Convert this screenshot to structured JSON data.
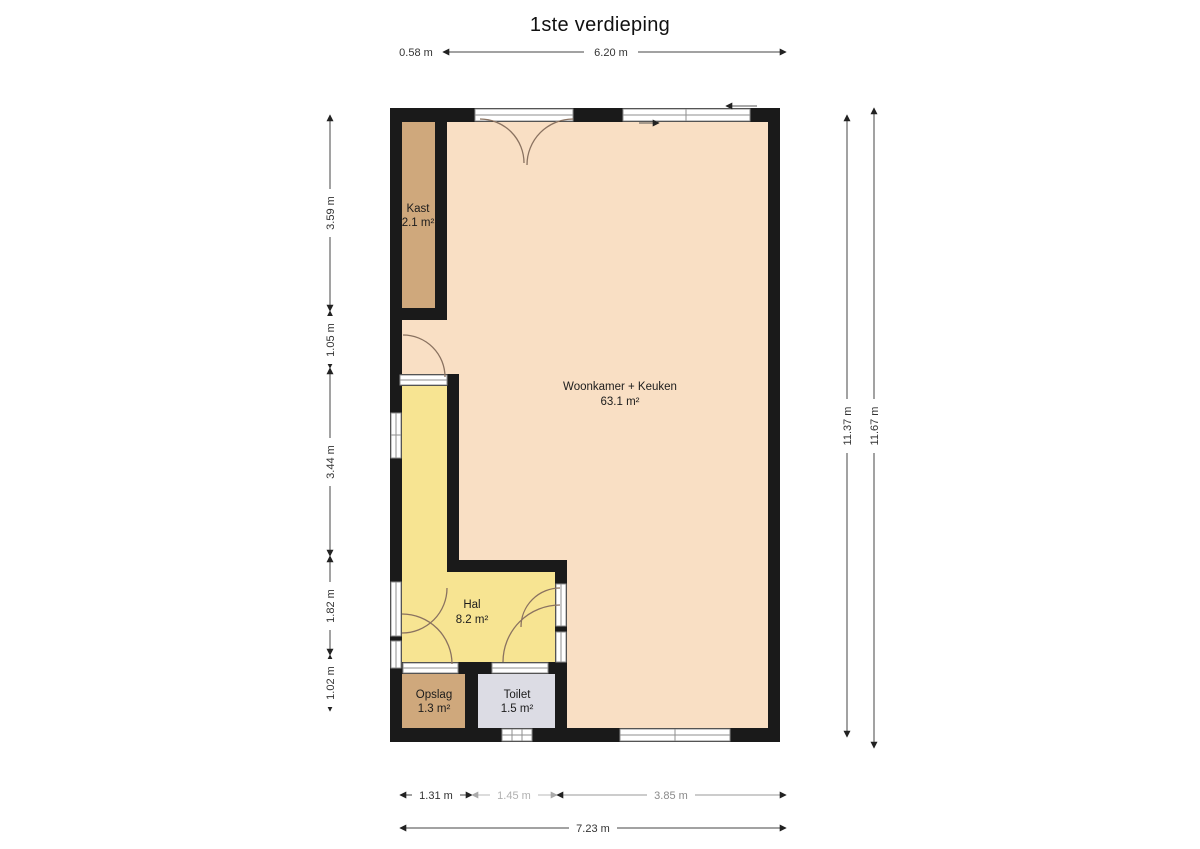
{
  "title": "1ste verdieping",
  "rooms": {
    "kast": {
      "name": "Kast",
      "area": "2.1 m²"
    },
    "woonkamer": {
      "name": "Woonkamer + Keuken",
      "area": "63.1 m²"
    },
    "hal": {
      "name": "Hal",
      "area": "8.2 m²"
    },
    "opslag": {
      "name": "Opslag",
      "area": "1.3 m²"
    },
    "toilet": {
      "name": "Toilet",
      "area": "1.5 m²"
    }
  },
  "dims": {
    "top_small": "0.58 m",
    "top_main": "6.20 m",
    "left_1": "3.59 m",
    "left_2": "1.05 m",
    "left_3": "3.44 m",
    "left_4": "1.82 m",
    "left_5": "1.02 m",
    "right_inner": "11.37 m",
    "right_outer": "11.67 m",
    "bottom_1": "1.31 m",
    "bottom_2": "1.45 m",
    "bottom_3": "3.85 m",
    "bottom_total": "7.23 m"
  },
  "colors": {
    "wall": "#1a1a1a",
    "woonkamer": "#f9dfc4",
    "kast": "#cfa87c",
    "hal": "#f7e492",
    "opslag": "#cfa87c",
    "toilet": "#dcdce4"
  }
}
